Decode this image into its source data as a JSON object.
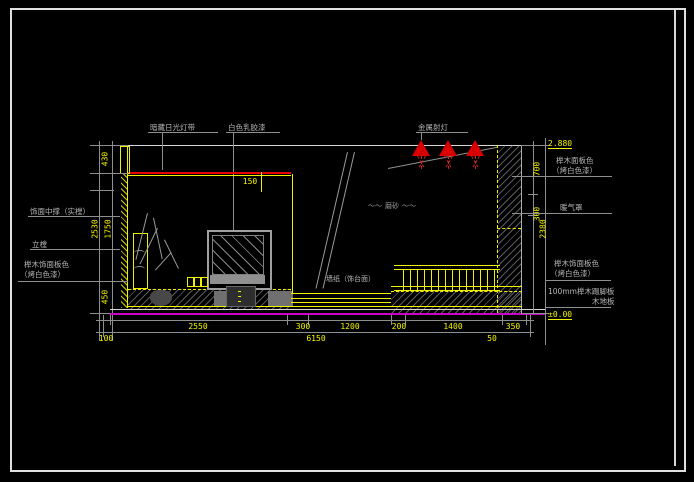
{
  "labels": {
    "hidden_light": "暗藏日光灯带",
    "white_paint": "白色乳胶漆",
    "metal_spotlight": "金属射灯",
    "frosted_glass": "磨砂",
    "frosted_squiggle": "～～",
    "left_top": "饰面中撑（实樘）",
    "left_upright": "立樘",
    "left_veneer_1": "榉木饰面板色",
    "left_veneer_2": "（烤白色漆）",
    "right_veneer_top_1": "榉木面板色",
    "right_veneer_top_2": "（烤白色漆）",
    "radiator_cover": "暖气罩",
    "right_veneer_bottom_1": "榉木饰面板色",
    "right_veneer_bottom_2": "（烤白色漆）",
    "skirting": "100mm榉木踢脚板",
    "wood_floor": "木地板",
    "mid_platform": "墙纸（饰台面）",
    "level_ceiling": "2.880",
    "level_floor": "±0.00",
    "cove_offset": "150"
  },
  "dims": {
    "left": {
      "d430": "430",
      "d2530": "2530",
      "d1750": "1750",
      "d450": "450"
    },
    "right": {
      "d700": "700",
      "d300": "300",
      "d2380": "2380"
    },
    "bottom_row1": [
      "2550",
      "300",
      "1200",
      "200",
      "1400",
      "350"
    ],
    "bottom_row2": [
      "100",
      "6150",
      "50"
    ]
  },
  "colors": {
    "background": "#000000",
    "frame": "#e0e0e0",
    "cad_yellow": "#f0f000",
    "cad_gray": "#8f8f8f",
    "cove_red": "#e60000",
    "floor_magenta": "#c800c8"
  }
}
